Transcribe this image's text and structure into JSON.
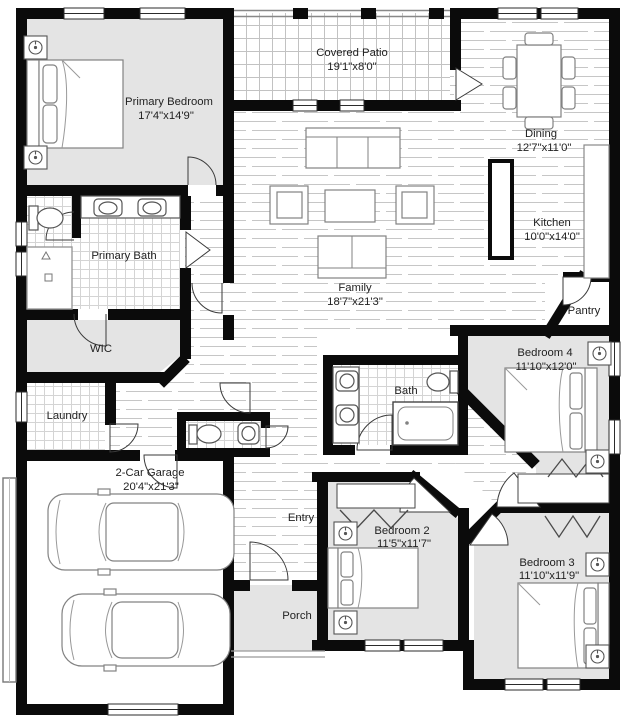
{
  "rooms": {
    "primary_bedroom": {
      "name": "Primary Bedroom",
      "dims": "17'4\"x14'9\""
    },
    "covered_patio": {
      "name": "Covered Patio",
      "dims": "19'1\"x8'0\""
    },
    "dining": {
      "name": "Dining",
      "dims": "12'7\"x11'0\""
    },
    "kitchen": {
      "name": "Kitchen",
      "dims": "10'0\"x14'0\""
    },
    "family": {
      "name": "Family",
      "dims": "18'7\"x21'3\""
    },
    "primary_bath": {
      "name": "Primary Bath",
      "dims": ""
    },
    "wic": {
      "name": "WIC",
      "dims": ""
    },
    "laundry": {
      "name": "Laundry",
      "dims": ""
    },
    "pantry": {
      "name": "Pantry",
      "dims": ""
    },
    "garage": {
      "name": "2-Car Garage",
      "dims": "20'4\"x21'3\""
    },
    "entry": {
      "name": "Entry",
      "dims": ""
    },
    "porch": {
      "name": "Porch",
      "dims": ""
    },
    "bath": {
      "name": "Bath",
      "dims": ""
    },
    "bedroom_2": {
      "name": "Bedroom 2",
      "dims": "11'5\"x11'7\""
    },
    "bedroom_3": {
      "name": "Bedroom 3",
      "dims": "11'10\"x11'9\""
    },
    "bedroom_4": {
      "name": "Bedroom 4",
      "dims": "11'10\"x12'0\""
    }
  },
  "colors": {
    "wall": "#0b0b0b",
    "room_fill": "#e4e4e4",
    "floor_line": "#c6c6c6",
    "tile_line": "#d4d4d4",
    "furniture_stroke": "#828282",
    "text": "#222222"
  }
}
